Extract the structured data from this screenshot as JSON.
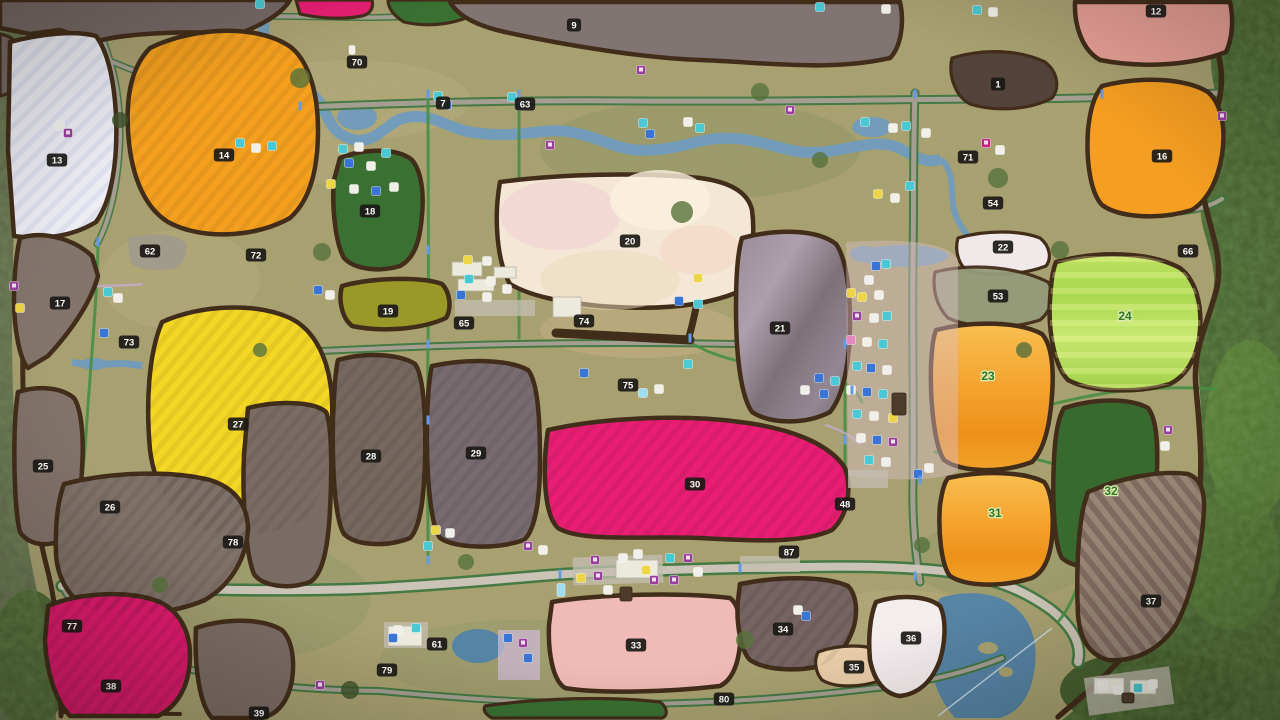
{
  "map": {
    "kind": "farm-map-overview",
    "field_labels": [
      {
        "n": "1",
        "x": 998,
        "y": 84
      },
      {
        "n": "7",
        "x": 443,
        "y": 103
      },
      {
        "n": "9",
        "x": 574,
        "y": 25
      },
      {
        "n": "12",
        "x": 1156,
        "y": 11
      },
      {
        "n": "13",
        "x": 57,
        "y": 160
      },
      {
        "n": "14",
        "x": 224,
        "y": 155
      },
      {
        "n": "16",
        "x": 1162,
        "y": 156
      },
      {
        "n": "17",
        "x": 60,
        "y": 303
      },
      {
        "n": "18",
        "x": 370,
        "y": 211
      },
      {
        "n": "19",
        "x": 388,
        "y": 311
      },
      {
        "n": "20",
        "x": 630,
        "y": 241
      },
      {
        "n": "21",
        "x": 780,
        "y": 328
      },
      {
        "n": "22",
        "x": 1003,
        "y": 247
      },
      {
        "n": "25",
        "x": 43,
        "y": 466
      },
      {
        "n": "26",
        "x": 110,
        "y": 507
      },
      {
        "n": "27",
        "x": 238,
        "y": 424
      },
      {
        "n": "28",
        "x": 371,
        "y": 456
      },
      {
        "n": "29",
        "x": 476,
        "y": 453
      },
      {
        "n": "30",
        "x": 695,
        "y": 484
      },
      {
        "n": "33",
        "x": 636,
        "y": 645
      },
      {
        "n": "34",
        "x": 783,
        "y": 629
      },
      {
        "n": "35",
        "x": 854,
        "y": 667
      },
      {
        "n": "36",
        "x": 911,
        "y": 638
      },
      {
        "n": "37",
        "x": 1151,
        "y": 601
      },
      {
        "n": "38",
        "x": 111,
        "y": 686
      },
      {
        "n": "39",
        "x": 259,
        "y": 713
      },
      {
        "n": "48",
        "x": 845,
        "y": 504
      },
      {
        "n": "53",
        "x": 998,
        "y": 296
      },
      {
        "n": "54",
        "x": 993,
        "y": 203
      },
      {
        "n": "61",
        "x": 437,
        "y": 644
      },
      {
        "n": "62",
        "x": 150,
        "y": 251
      },
      {
        "n": "63",
        "x": 525,
        "y": 104
      },
      {
        "n": "65",
        "x": 464,
        "y": 323
      },
      {
        "n": "66",
        "x": 1188,
        "y": 251
      },
      {
        "n": "70",
        "x": 357,
        "y": 62
      },
      {
        "n": "71",
        "x": 968,
        "y": 157
      },
      {
        "n": "72",
        "x": 256,
        "y": 255
      },
      {
        "n": "73",
        "x": 129,
        "y": 342
      },
      {
        "n": "74",
        "x": 584,
        "y": 321
      },
      {
        "n": "75",
        "x": 628,
        "y": 385
      },
      {
        "n": "77",
        "x": 72,
        "y": 626
      },
      {
        "n": "78",
        "x": 233,
        "y": 542
      },
      {
        "n": "79",
        "x": 387,
        "y": 670
      },
      {
        "n": "80",
        "x": 724,
        "y": 699
      },
      {
        "n": "87",
        "x": 789,
        "y": 552
      }
    ],
    "green_field_labels": [
      {
        "n": "23",
        "x": 988,
        "y": 376
      },
      {
        "n": "24",
        "x": 1125,
        "y": 316
      },
      {
        "n": "31",
        "x": 995,
        "y": 513
      },
      {
        "n": "32",
        "x": 1111,
        "y": 491
      }
    ],
    "label_style": {
      "badge_bg": "#0e0d0b",
      "badge_text": "#ffffff",
      "green_text": "#256f15",
      "green_halo": "#dcedb4"
    },
    "field_fills": {
      "f13": "#edeef6",
      "ftl": "#6e6260",
      "ftl2": "#6e6260",
      "fpink_top": "#e8136e",
      "fgreen_top": "#2f6b2a",
      "f9": "#7b6f6e",
      "f1": "#4a3a31",
      "f12": "#e79c93",
      "f16": "#f79b17",
      "f14": "#f59d14",
      "f18": "#2f6b2a",
      "f17": "#7d6f67",
      "f19": "#95941f",
      "f22": "#f2e9ec",
      "f53": "#8f9775",
      "f25": "#7b6c64",
      "f26": "#786b62",
      "f27": "#f5d61b",
      "f28": "#6f6159",
      "f29": "#70646a",
      "f30": "#e8116e",
      "f32": "#2d6327",
      "f33": "#f1b8b5",
      "f34": "#6f5d5c",
      "f35": "#eacda7",
      "f36": "#f4eef1",
      "f38": "#df0f67",
      "f39": "#75665f",
      "f20": "#f6e8d6",
      "funl": "#72655e",
      "fbot_green": "#2f6b2a",
      "f62patch": "#9a958a"
    },
    "icon_colors": {
      "purple": "#93359b",
      "magenta": "#c2187f",
      "teal": "#3fc8d4",
      "blue": "#2f6fd6",
      "lightblue": "#9adcf2",
      "yellow": "#ecd53e",
      "white": "#f2f1ec",
      "pink": "#e585c0",
      "darkbld": "#44311f",
      "roadmark": "#5b97e8"
    },
    "poi_icons": [
      {
        "x": 260,
        "y": 4,
        "c": "teal"
      },
      {
        "x": 820,
        "y": 7,
        "c": "teal"
      },
      {
        "x": 886,
        "y": 9,
        "c": "white"
      },
      {
        "x": 977,
        "y": 10,
        "c": "teal"
      },
      {
        "x": 993,
        "y": 12,
        "c": "white"
      },
      {
        "x": 352,
        "y": 50,
        "c": "white",
        "w": 6,
        "h": 9
      },
      {
        "x": 438,
        "y": 96,
        "c": "teal"
      },
      {
        "x": 447,
        "y": 105,
        "c": "blue"
      },
      {
        "x": 512,
        "y": 97,
        "c": "teal"
      },
      {
        "x": 520,
        "y": 106,
        "c": "blue"
      },
      {
        "x": 641,
        "y": 70,
        "c": "purple"
      },
      {
        "x": 550,
        "y": 145,
        "c": "purple"
      },
      {
        "x": 790,
        "y": 110,
        "c": "purple"
      },
      {
        "x": 643,
        "y": 123,
        "c": "teal"
      },
      {
        "x": 650,
        "y": 134,
        "c": "blue"
      },
      {
        "x": 688,
        "y": 122,
        "c": "white"
      },
      {
        "x": 700,
        "y": 128,
        "c": "teal"
      },
      {
        "x": 865,
        "y": 122,
        "c": "teal"
      },
      {
        "x": 893,
        "y": 128,
        "c": "white"
      },
      {
        "x": 906,
        "y": 126,
        "c": "teal"
      },
      {
        "x": 926,
        "y": 133,
        "c": "white"
      },
      {
        "x": 986,
        "y": 143,
        "c": "magenta"
      },
      {
        "x": 1000,
        "y": 150,
        "c": "white"
      },
      {
        "x": 1222,
        "y": 116,
        "c": "purple"
      },
      {
        "x": 878,
        "y": 194,
        "c": "yellow"
      },
      {
        "x": 895,
        "y": 198,
        "c": "white"
      },
      {
        "x": 910,
        "y": 186,
        "c": "teal"
      },
      {
        "x": 14,
        "y": 286,
        "c": "purple"
      },
      {
        "x": 20,
        "y": 308,
        "c": "yellow"
      },
      {
        "x": 60,
        "y": 126,
        "c": "white"
      },
      {
        "x": 68,
        "y": 133,
        "c": "purple"
      },
      {
        "x": 108,
        "y": 292,
        "c": "teal"
      },
      {
        "x": 118,
        "y": 298,
        "c": "white"
      },
      {
        "x": 104,
        "y": 333,
        "c": "blue"
      },
      {
        "x": 240,
        "y": 143,
        "c": "teal"
      },
      {
        "x": 256,
        "y": 148,
        "c": "white"
      },
      {
        "x": 272,
        "y": 146,
        "c": "teal"
      },
      {
        "x": 318,
        "y": 290,
        "c": "blue"
      },
      {
        "x": 330,
        "y": 295,
        "c": "white"
      },
      {
        "x": 343,
        "y": 149,
        "c": "teal"
      },
      {
        "x": 359,
        "y": 147,
        "c": "white"
      },
      {
        "x": 349,
        "y": 163,
        "c": "blue"
      },
      {
        "x": 371,
        "y": 166,
        "c": "white"
      },
      {
        "x": 386,
        "y": 153,
        "c": "teal"
      },
      {
        "x": 331,
        "y": 184,
        "c": "yellow"
      },
      {
        "x": 354,
        "y": 189,
        "c": "white"
      },
      {
        "x": 376,
        "y": 191,
        "c": "blue"
      },
      {
        "x": 394,
        "y": 187,
        "c": "white"
      },
      {
        "x": 468,
        "y": 260,
        "c": "yellow"
      },
      {
        "x": 487,
        "y": 261,
        "c": "white"
      },
      {
        "x": 469,
        "y": 279,
        "c": "teal"
      },
      {
        "x": 491,
        "y": 281,
        "c": "white"
      },
      {
        "x": 461,
        "y": 295,
        "c": "blue"
      },
      {
        "x": 487,
        "y": 297,
        "c": "white"
      },
      {
        "x": 507,
        "y": 289,
        "c": "white"
      },
      {
        "x": 698,
        "y": 278,
        "c": "yellow"
      },
      {
        "x": 679,
        "y": 301,
        "c": "blue"
      },
      {
        "x": 698,
        "y": 304,
        "c": "teal"
      },
      {
        "x": 584,
        "y": 373,
        "c": "blue"
      },
      {
        "x": 643,
        "y": 393,
        "c": "lightblue"
      },
      {
        "x": 659,
        "y": 389,
        "c": "white"
      },
      {
        "x": 688,
        "y": 364,
        "c": "teal"
      },
      {
        "x": 819,
        "y": 378,
        "c": "blue"
      },
      {
        "x": 835,
        "y": 381,
        "c": "teal"
      },
      {
        "x": 805,
        "y": 390,
        "c": "white"
      },
      {
        "x": 824,
        "y": 394,
        "c": "blue"
      },
      {
        "x": 876,
        "y": 266,
        "c": "blue"
      },
      {
        "x": 886,
        "y": 264,
        "c": "teal"
      },
      {
        "x": 869,
        "y": 280,
        "c": "white"
      },
      {
        "x": 851,
        "y": 293,
        "c": "yellow"
      },
      {
        "x": 862,
        "y": 297,
        "c": "yellow"
      },
      {
        "x": 879,
        "y": 295,
        "c": "white"
      },
      {
        "x": 857,
        "y": 316,
        "c": "purple"
      },
      {
        "x": 874,
        "y": 318,
        "c": "white"
      },
      {
        "x": 887,
        "y": 316,
        "c": "teal"
      },
      {
        "x": 851,
        "y": 340,
        "c": "pink"
      },
      {
        "x": 867,
        "y": 342,
        "c": "white"
      },
      {
        "x": 883,
        "y": 344,
        "c": "teal"
      },
      {
        "x": 857,
        "y": 366,
        "c": "teal"
      },
      {
        "x": 871,
        "y": 368,
        "c": "blue"
      },
      {
        "x": 887,
        "y": 370,
        "c": "white"
      },
      {
        "x": 851,
        "y": 390,
        "c": "white"
      },
      {
        "x": 867,
        "y": 392,
        "c": "blue"
      },
      {
        "x": 883,
        "y": 394,
        "c": "teal"
      },
      {
        "x": 857,
        "y": 414,
        "c": "teal"
      },
      {
        "x": 874,
        "y": 416,
        "c": "white"
      },
      {
        "x": 893,
        "y": 418,
        "c": "yellow"
      },
      {
        "x": 899,
        "y": 404,
        "c": "darkbld",
        "w": 14,
        "h": 22
      },
      {
        "x": 861,
        "y": 438,
        "c": "white"
      },
      {
        "x": 877,
        "y": 440,
        "c": "blue"
      },
      {
        "x": 893,
        "y": 442,
        "c": "purple"
      },
      {
        "x": 869,
        "y": 460,
        "c": "teal"
      },
      {
        "x": 886,
        "y": 462,
        "c": "white"
      },
      {
        "x": 918,
        "y": 474,
        "c": "blue"
      },
      {
        "x": 929,
        "y": 468,
        "c": "white"
      },
      {
        "x": 561,
        "y": 590,
        "c": "lightblue",
        "w": 8,
        "h": 13
      },
      {
        "x": 581,
        "y": 578,
        "c": "yellow"
      },
      {
        "x": 595,
        "y": 560,
        "c": "purple"
      },
      {
        "x": 598,
        "y": 576,
        "c": "purple"
      },
      {
        "x": 646,
        "y": 570,
        "c": "yellow"
      },
      {
        "x": 654,
        "y": 580,
        "c": "purple"
      },
      {
        "x": 674,
        "y": 580,
        "c": "purple"
      },
      {
        "x": 623,
        "y": 558,
        "c": "white"
      },
      {
        "x": 638,
        "y": 554,
        "c": "white"
      },
      {
        "x": 608,
        "y": 590,
        "c": "white"
      },
      {
        "x": 626,
        "y": 594,
        "c": "darkbld",
        "w": 12,
        "h": 14
      },
      {
        "x": 670,
        "y": 558,
        "c": "teal"
      },
      {
        "x": 688,
        "y": 558,
        "c": "purple"
      },
      {
        "x": 698,
        "y": 572,
        "c": "white"
      },
      {
        "x": 528,
        "y": 546,
        "c": "purple"
      },
      {
        "x": 543,
        "y": 550,
        "c": "white"
      },
      {
        "x": 436,
        "y": 530,
        "c": "yellow"
      },
      {
        "x": 450,
        "y": 533,
        "c": "white"
      },
      {
        "x": 428,
        "y": 546,
        "c": "teal"
      },
      {
        "x": 508,
        "y": 638,
        "c": "blue"
      },
      {
        "x": 523,
        "y": 643,
        "c": "purple"
      },
      {
        "x": 528,
        "y": 658,
        "c": "blue"
      },
      {
        "x": 416,
        "y": 628,
        "c": "teal"
      },
      {
        "x": 398,
        "y": 630,
        "c": "white"
      },
      {
        "x": 393,
        "y": 638,
        "c": "blue"
      },
      {
        "x": 320,
        "y": 685,
        "c": "purple"
      },
      {
        "x": 1168,
        "y": 430,
        "c": "purple"
      },
      {
        "x": 1165,
        "y": 446,
        "c": "white"
      },
      {
        "x": 1103,
        "y": 686,
        "c": "white"
      },
      {
        "x": 1118,
        "y": 690,
        "c": "white"
      },
      {
        "x": 1138,
        "y": 688,
        "c": "teal"
      },
      {
        "x": 1153,
        "y": 684,
        "c": "white"
      },
      {
        "x": 1128,
        "y": 698,
        "c": "darkbld",
        "w": 12,
        "h": 10
      },
      {
        "x": 798,
        "y": 610,
        "c": "white"
      },
      {
        "x": 806,
        "y": 616,
        "c": "blue"
      },
      {
        "x": 428,
        "y": 94,
        "c": "roadmark",
        "w": 3,
        "h": 9
      },
      {
        "x": 519,
        "y": 94,
        "c": "roadmark",
        "w": 3,
        "h": 9
      },
      {
        "x": 915,
        "y": 94,
        "c": "roadmark",
        "w": 3,
        "h": 9
      },
      {
        "x": 1102,
        "y": 94,
        "c": "roadmark",
        "w": 3,
        "h": 9
      },
      {
        "x": 428,
        "y": 250,
        "c": "roadmark",
        "w": 3,
        "h": 9
      },
      {
        "x": 428,
        "y": 344,
        "c": "roadmark",
        "w": 3,
        "h": 9
      },
      {
        "x": 845,
        "y": 344,
        "c": "roadmark",
        "w": 3,
        "h": 9
      },
      {
        "x": 428,
        "y": 560,
        "c": "roadmark",
        "w": 3,
        "h": 9
      },
      {
        "x": 915,
        "y": 576,
        "c": "roadmark",
        "w": 3,
        "h": 9
      },
      {
        "x": 740,
        "y": 568,
        "c": "roadmark",
        "w": 3,
        "h": 9
      },
      {
        "x": 690,
        "y": 338,
        "c": "roadmark",
        "w": 3,
        "h": 9
      },
      {
        "x": 852,
        "y": 390,
        "c": "roadmark",
        "w": 3,
        "h": 9
      },
      {
        "x": 300,
        "y": 106,
        "c": "roadmark",
        "w": 3,
        "h": 9
      },
      {
        "x": 98,
        "y": 242,
        "c": "roadmark",
        "w": 3,
        "h": 9
      },
      {
        "x": 560,
        "y": 574,
        "c": "roadmark",
        "w": 3,
        "h": 9
      },
      {
        "x": 920,
        "y": 480,
        "c": "roadmark",
        "w": 3,
        "h": 9
      },
      {
        "x": 428,
        "y": 420,
        "c": "roadmark",
        "w": 3,
        "h": 9
      },
      {
        "x": 845,
        "y": 440,
        "c": "roadmark",
        "w": 3,
        "h": 9
      }
    ]
  }
}
